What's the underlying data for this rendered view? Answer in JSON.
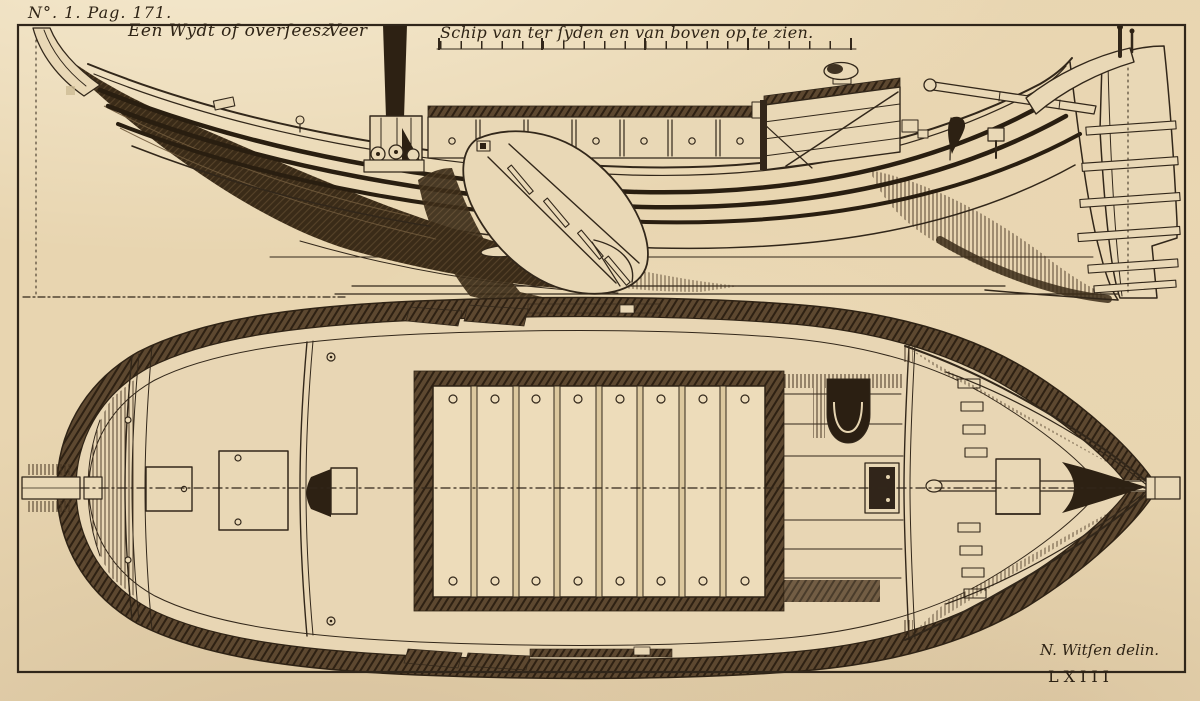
{
  "plate": {
    "page_ref": "N°. 1. Pag. 171.",
    "title": {
      "part1": "Een Wydt of overſeesz",
      "part2": "Veer",
      "part3": "Schip van ter ſyden en van boven op te zien."
    },
    "signature": "N. Witſen delin.",
    "plate_number": "LXIII"
  },
  "figure": {
    "type": "engraved ship plate",
    "views": [
      "side view",
      "top view"
    ]
  },
  "colors": {
    "paper": "#e8d5b0",
    "ink": "#32271a",
    "shading": "#3a2b18"
  }
}
